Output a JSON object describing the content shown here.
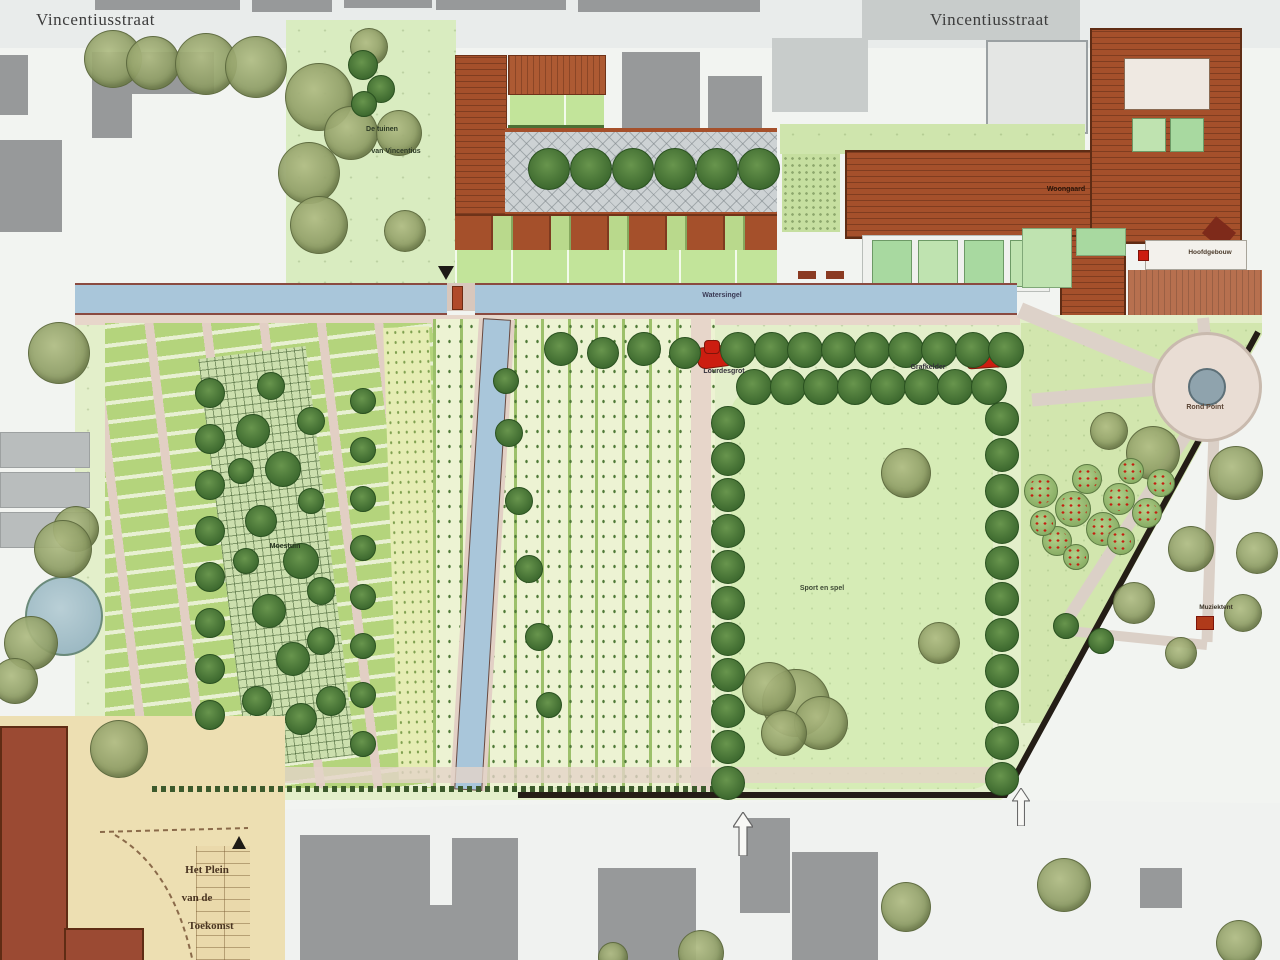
{
  "streets": {
    "top_left": "Vincentiusstraat",
    "top_right": "Vincentiusstraat"
  },
  "labels": {
    "water_canal": "Watersingel",
    "lourdes_grotto": "Lourdesgrot",
    "burial_vault": "Grafkelder",
    "round_plaza": "Rond Point",
    "sports_lawn": "Sport en spel",
    "allotment_garden": "Moestuin",
    "garden_note_line1": "De tuinen",
    "garden_note_line2": "van Vincentius",
    "care_building": "Woongaard",
    "main_building": "Hoofdgebouw",
    "music_pavilion": "Muziektent",
    "future_square_line1": "Het Plein",
    "future_square_line2": "van de",
    "future_square_line3": "Toekomst"
  },
  "colors": {
    "water": "#a9c6da",
    "brick_building": "#a5502b",
    "lawn": "#d6ecb6",
    "garden_bed": "#b4d47c",
    "path_pink": "#e2cfc4",
    "dark_tree": "#3c682e",
    "olive_tree": "#a8b478",
    "red_marker": "#cc1d10",
    "site_boundary": "#241d16",
    "tan_square": "#ead9ab",
    "gray_building": "#97999a"
  }
}
